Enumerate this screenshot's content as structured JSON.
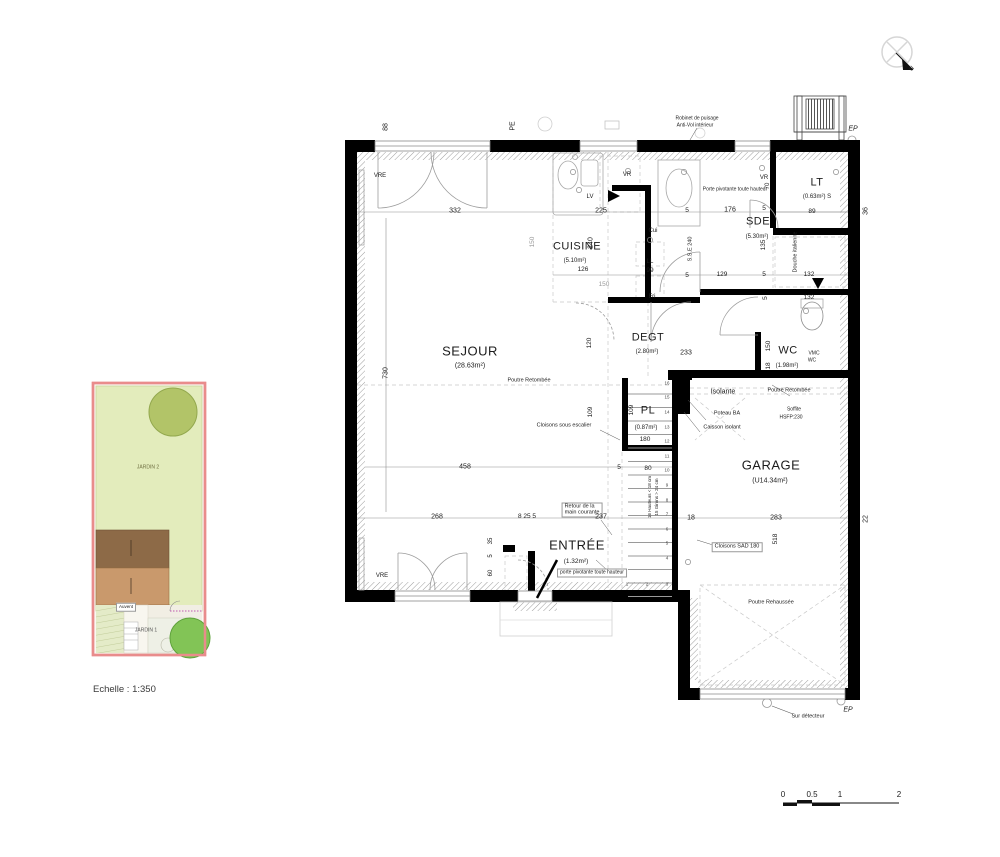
{
  "north": {
    "label": "N"
  },
  "scale": {
    "echelle_label": "Echelle : 1:350",
    "bar_ticks": [
      "0",
      "0.5",
      "1",
      "2"
    ]
  },
  "site_plan": {
    "jardin2_label": "JARDIN 2",
    "jardin1_label": "JARDIN 1",
    "auvent_label": "Auvent",
    "colors": {
      "border": "#e98c8c",
      "grass": "#e3ecbc",
      "tree_dark": "#b2c468",
      "tree_bright": "#82c456",
      "roof_dark": "#8d6a47",
      "roof_mid": "#c9996c"
    }
  },
  "rooms": {
    "sejour": {
      "name": "SEJOUR",
      "area": "(28.63m²)"
    },
    "cuisine": {
      "name": "CUISINE",
      "area": "(5.10m²)"
    },
    "degt": {
      "name": "DEGT",
      "area": "(2.80m²)"
    },
    "sde": {
      "name": "SDE",
      "area": "(5.30m²)"
    },
    "lt": {
      "name": "LT",
      "area": "(0.63m²) S"
    },
    "wc": {
      "name": "WC",
      "area": "(1.98m²)"
    },
    "pl": {
      "name": "PL",
      "area": "(0.87m²)",
      "height": "180"
    },
    "entree": {
      "name": "ENTRÉE",
      "area": "(1.32m²)"
    },
    "garage": {
      "name": "GARAGE",
      "area": "(U14.34m²)"
    }
  },
  "annotations": {
    "robinet_line1": "Robinet de puisage",
    "robinet_line2": "Anti-Vol intérieur",
    "porte_pivotante_sde": "Porte pivotante toute hauteur",
    "porte_pivotante_entree": "porte pivotante toute hauteur",
    "douche_italienne": "Douche italienne",
    "poutre_retombee": "Poutre Retombée",
    "poutre_rehaussee": "Poutre Rehaussée",
    "cloisons_sous_escalier": "Cloisons sous escalier",
    "retour_main_courante_l1": "Retour de la",
    "retour_main_courante_l2": "main courante",
    "isolante": "Isolante",
    "poteau_ba": "Poteau BA",
    "caisson_isolant": "Caisson isolant",
    "soffite_l1": "Soffite",
    "soffite_l2": "HSFP:230",
    "cloisons_sad": "Cloisons SAD 180",
    "sur_detecteur": "Sur détecteur",
    "vmc_l1": "VMC",
    "vmc_l2": "WC",
    "stair_note_l1": "16 Hauteurs < 18 cm",
    "stair_note_l2": "15 Girons > 24 cm",
    "vre": "VRE",
    "vr": "VR",
    "lv": "LV",
    "cui": "Cui",
    "ll": "LL",
    "fri": "Fri",
    "sse": "S.S.E 240",
    "ep": "EP",
    "pe": "PE"
  },
  "dimensions": {
    "d332": "332",
    "d225": "225",
    "d176": "176",
    "d70": "70",
    "d88": "88",
    "d36": "36",
    "d22": "22",
    "d240": "240",
    "d150": "150",
    "d126": "126",
    "d99": "99",
    "d129": "129",
    "d132": "132",
    "d135": "135",
    "d89": "89",
    "d730": "730",
    "d120": "120",
    "d109": "109",
    "d233": "233",
    "d458": "458",
    "d80": "80",
    "d5": "5",
    "d237": "237",
    "d18": "18",
    "d283": "283",
    "d518": "518",
    "d268": "268",
    "d8_25_5": "8 25 5",
    "d35": "35",
    "d60": "60",
    "d180": "180"
  },
  "stairs": {
    "numbers": [
      "1",
      "2",
      "3",
      "4",
      "5",
      "6",
      "7",
      "8",
      "9",
      "10",
      "11",
      "12",
      "13",
      "14",
      "15",
      "16"
    ]
  }
}
